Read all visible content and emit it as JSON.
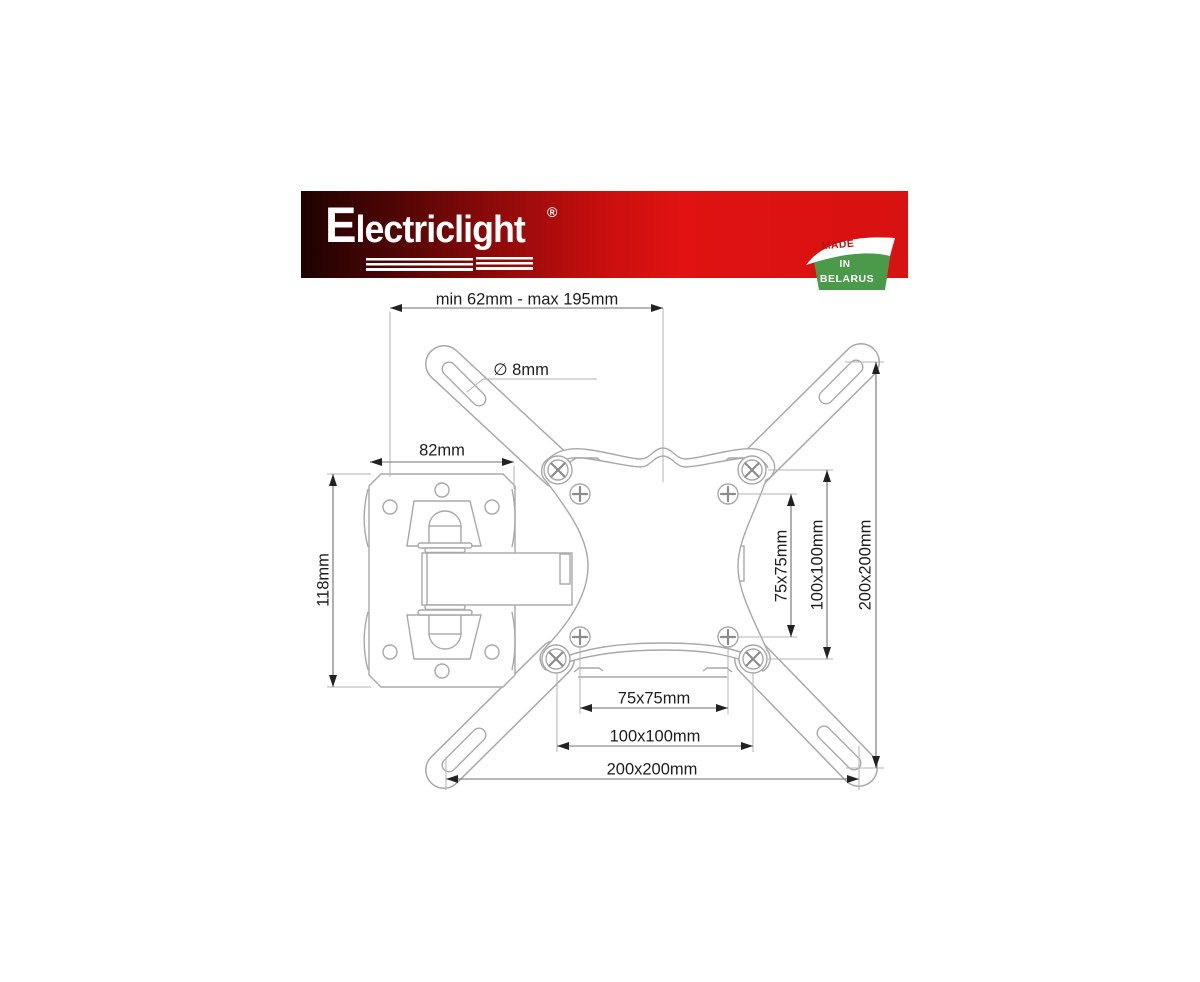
{
  "banner": {
    "brand": "Electriclight",
    "registered_mark": "®",
    "badge": {
      "made": "MADE",
      "in": "IN",
      "belarus": "BELARUS"
    },
    "colors": {
      "banner_red": "#e01212",
      "banner_dark": "#1f0202",
      "badge_green": "#4a9a49",
      "badge_text_red": "#b31515"
    }
  },
  "diagram": {
    "labels": {
      "extension_range": "min 62mm - max 195mm",
      "hole_diameter": "∅ 8mm",
      "wall_plate_width": "82mm",
      "wall_plate_height": "118mm",
      "vesa_75_vertical": "75x75mm",
      "vesa_100_vertical": "100x100mm",
      "vesa_200_vertical": "200x200mm",
      "vesa_75_horizontal": "75x75mm",
      "vesa_100_horizontal": "100x100mm",
      "vesa_200_horizontal": "200x200mm"
    },
    "colors": {
      "outline_gray": "#a8a8a8",
      "dimension_gray": "#707070",
      "text_color": "#1d1d1d"
    }
  }
}
